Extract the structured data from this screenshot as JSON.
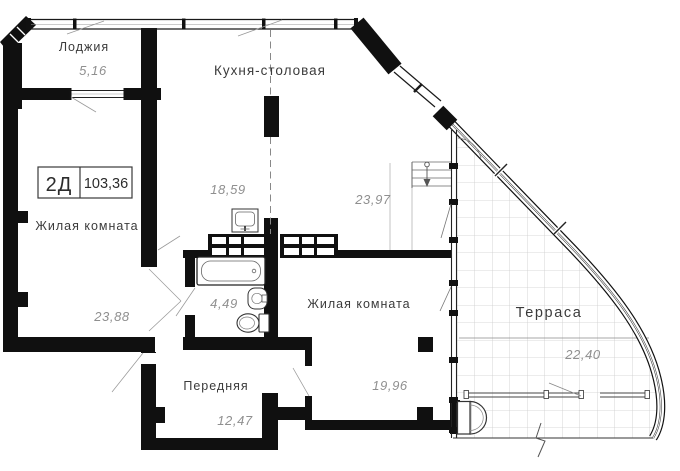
{
  "plan": {
    "title_box": {
      "type": "2Д",
      "total_area": "103,36"
    },
    "rooms": {
      "loggia": {
        "label": "Лоджия",
        "area": "5,16"
      },
      "kitchen_dining": {
        "label": "Кухня-столовая",
        "area_kitchen_zone": "18,59",
        "area_dining_zone": "23,97"
      },
      "living_room_left": {
        "label": "Жилая комната",
        "area": "23,88"
      },
      "bathroom": {
        "area": "4,49"
      },
      "living_room_right": {
        "label": "Жилая комната",
        "area": "19,96"
      },
      "hallway": {
        "label": "Передняя",
        "area": "12,47"
      },
      "terrace": {
        "label": "Терраса",
        "area": "22,40"
      }
    },
    "colors": {
      "wall": "#101010",
      "tile_grid": "#cccccc",
      "label": "#3b3b3b",
      "area_value": "#8f8f8f"
    }
  }
}
